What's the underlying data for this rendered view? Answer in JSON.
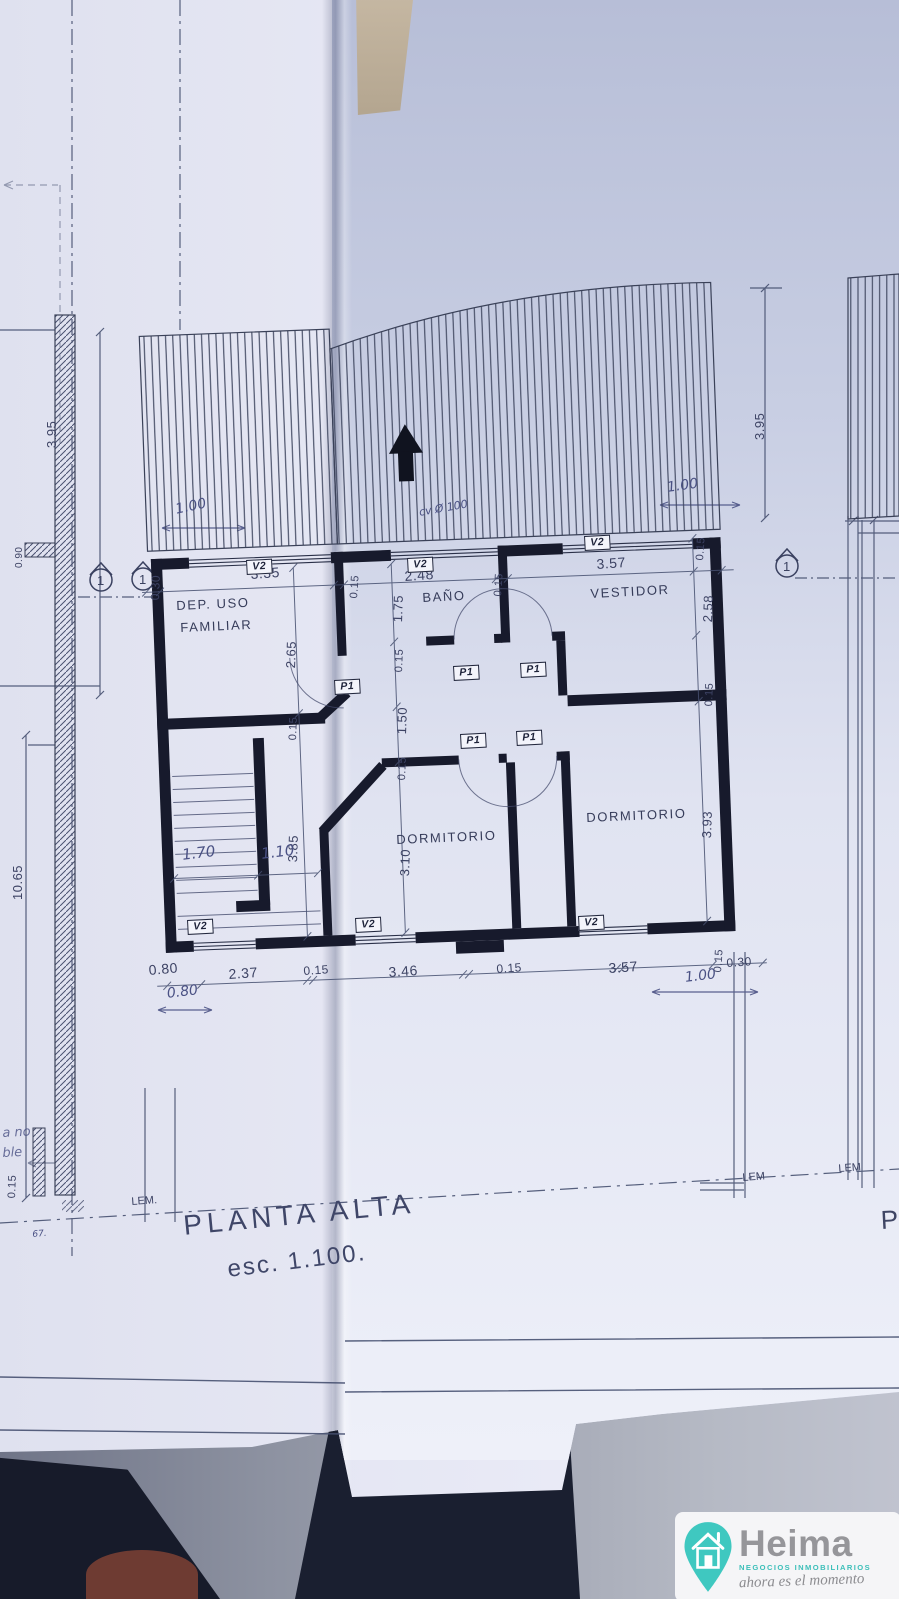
{
  "title": {
    "main": "PLANTA ALTA",
    "scale": "esc. 1.100."
  },
  "rooms": {
    "dep1": "DEP. USO",
    "dep2": "FAMILIAR",
    "bath": "BAÑO",
    "dressing": "VESTIDOR",
    "bed_mid": "DORMITORIO",
    "bed_right": "DORMITORIO"
  },
  "tags": {
    "window": "V2",
    "door": "P1"
  },
  "dims": {
    "top": [
      "0.30",
      "3.35",
      "0.15",
      "2.48",
      "0.15",
      "3.57",
      "0.15"
    ],
    "bottom": [
      "0.80",
      "2.37",
      "0.15",
      "3.46",
      "0.15",
      "3.57",
      "0.30",
      "0.15"
    ],
    "left": [
      "2.65",
      "0.15",
      "3.85"
    ],
    "mid": [
      "1.75",
      "0.15",
      "1.50",
      "0.15",
      "3.10"
    ],
    "right": [
      "2.58",
      "0.15",
      "3.93"
    ],
    "outer_left": "3.95",
    "outer_right": "3.95",
    "total": "10.65",
    "ledge": "0.90",
    "corner_bl": "0.15"
  },
  "hand": {
    "roof_left": "1.00",
    "roof_right": "1.00",
    "br": "1.00",
    "bl": "0.80",
    "stair1": "1.70",
    "stair2": "1.10",
    "pipe": "cv Ø 100",
    "tiny": "67."
  },
  "markers": {
    "section": "1",
    "lem_left": "LEM.",
    "lem_mid": "LEM",
    "lem_right": "LEM",
    "partial": "P"
  },
  "bleed": {
    "l1": "bomba agua",
    "l2": "potable",
    "l3": "a no",
    "l4": "ble"
  },
  "logo": {
    "brand": "Heima",
    "subtitle": "NEGOCIOS INMOBILIARIOS",
    "tagline": "ahora es el momento"
  }
}
